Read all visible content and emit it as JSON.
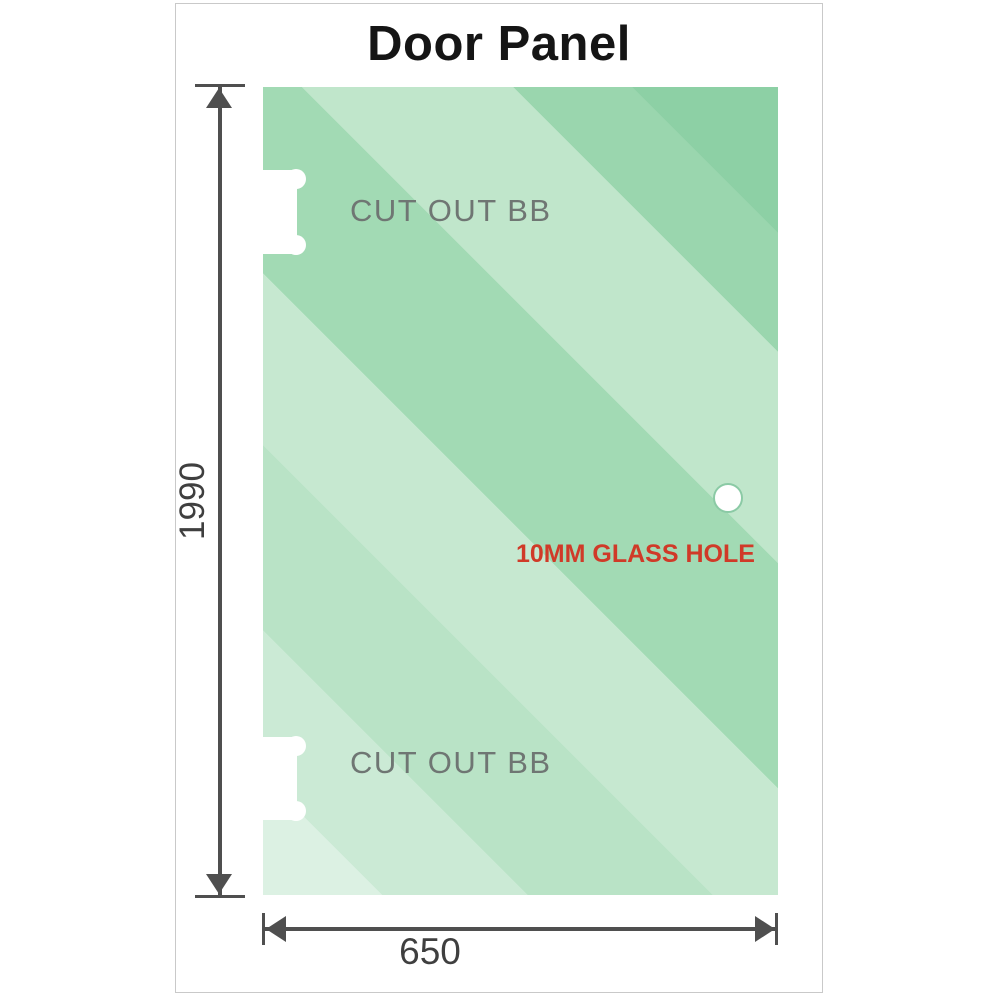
{
  "header": {
    "title": "Door Panel"
  },
  "panel": {
    "cutout_top_label": "CUT OUT BB",
    "cutout_bottom_label": "CUT OUT BB",
    "hole_label": "10MM GLASS HOLE"
  },
  "dimensions": {
    "height_value": "1990",
    "width_value": "650"
  },
  "colors": {
    "glass_base_green": "#8dd0a5",
    "glass_lightest_green": "#dcf1e3",
    "dimension_line_gray": "#4f4f4f",
    "cutout_label_gray": "#6f7673",
    "hole_label_red": "#d03a28",
    "frame_border_gray": "#c9c9c9"
  }
}
